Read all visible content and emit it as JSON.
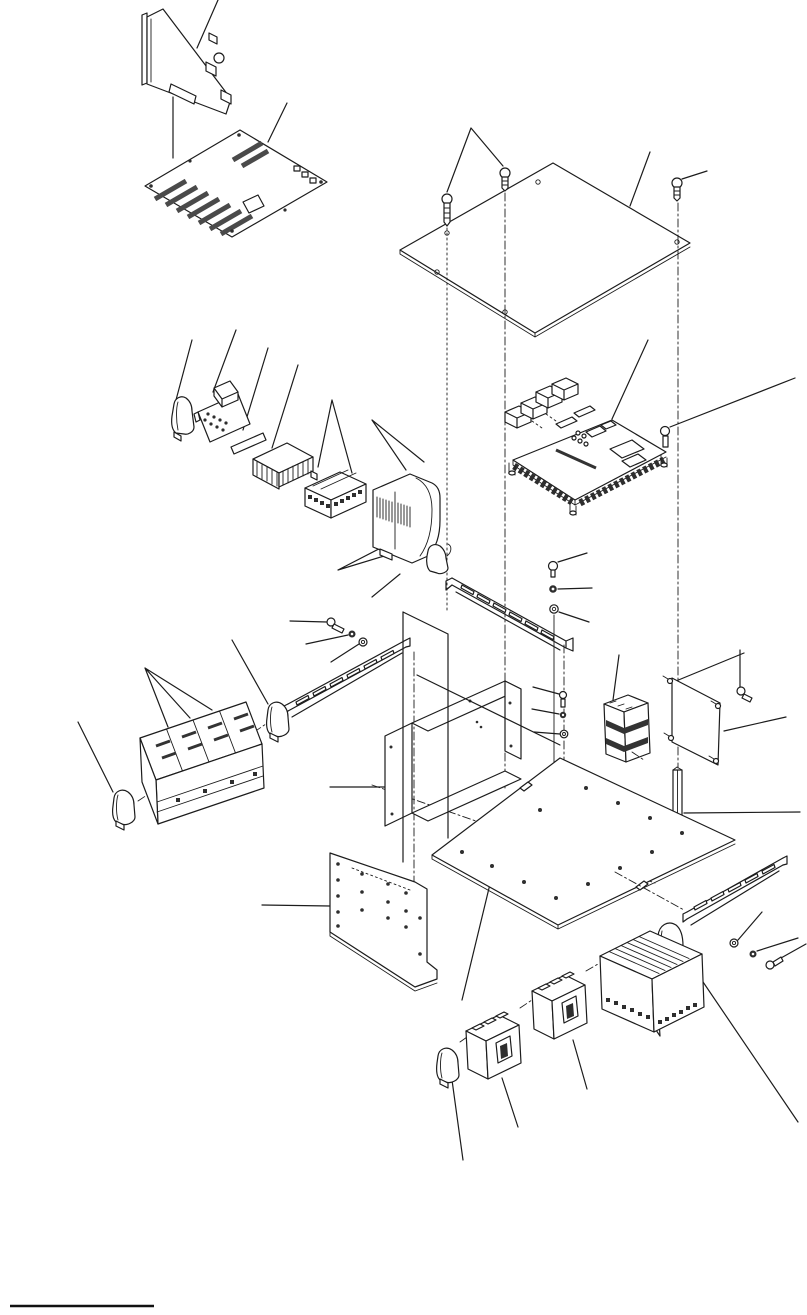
{
  "figure": {
    "kind": "exploded-parts-diagram",
    "description": "Exploded isometric service-manual illustration of an industrial control unit: cover plate, circuit boards, DIN rails, terminal blocks, circuit breakers, brackets and fasteners connected by leader lines",
    "labels_visible": false,
    "footnote_rule": {
      "present": true
    }
  },
  "colors": {
    "background": "#ffffff",
    "line": "#1c1c1c",
    "dark_fill": "#2e2e2e",
    "slot_fill": "#4a4a4a",
    "rule": "#111111"
  },
  "parts": [
    {
      "id": "adapter-card",
      "label": "Adapter card"
    },
    {
      "id": "backplane-board",
      "label": "Backplane board with slots"
    },
    {
      "id": "top-cover-plate",
      "label": "Top cover plate"
    },
    {
      "id": "cover-screws",
      "label": "Cover screws and alignment lines"
    },
    {
      "id": "controller-board",
      "label": "Controller board with connectors"
    },
    {
      "id": "controller-screw",
      "label": "Controller board screw"
    },
    {
      "id": "relay-end-clamp",
      "label": "End clamp"
    },
    {
      "id": "relay-socket",
      "label": "Relay and socket"
    },
    {
      "id": "marker-plate",
      "label": "Marker plate"
    },
    {
      "id": "spacer-block",
      "label": "Spacer block"
    },
    {
      "id": "terminal-connector",
      "label": "Terminal connector"
    },
    {
      "id": "power-module",
      "label": "Power module"
    },
    {
      "id": "module-end-clamp",
      "label": "End clamp"
    },
    {
      "id": "din-rail-center",
      "label": "DIN rail (center)"
    },
    {
      "id": "rail-fasteners-center",
      "label": "Screw, nut and washer"
    },
    {
      "id": "din-rail-left",
      "label": "DIN rail (left)"
    },
    {
      "id": "rail-fasteners-left",
      "label": "Screw, nut and washer"
    },
    {
      "id": "terminal-block-bank",
      "label": "Terminal block bank"
    },
    {
      "id": "bank-end-clamps",
      "label": "End clamps"
    },
    {
      "id": "mounting-bracket",
      "label": "Mounting bracket"
    },
    {
      "id": "divider-sheet",
      "label": "Divider sheet"
    },
    {
      "id": "stacked-terminal-block",
      "label": "Stacked terminal block"
    },
    {
      "id": "fastener-set-right",
      "label": "Screw, nut and washer"
    },
    {
      "id": "side-panel",
      "label": "Side panel with standoffs"
    },
    {
      "id": "panel-screw",
      "label": "Panel screw"
    },
    {
      "id": "support-rod",
      "label": "Support rod"
    },
    {
      "id": "base-plate",
      "label": "Base plate"
    },
    {
      "id": "mounting-plate",
      "label": "Mounting plate"
    },
    {
      "id": "din-rail-bottom",
      "label": "DIN rail (bottom)"
    },
    {
      "id": "rail-fasteners-bottom",
      "label": "Washer, nut and screw"
    },
    {
      "id": "rail-end-clamp",
      "label": "Rail end clamp"
    },
    {
      "id": "terminal-block-large",
      "label": "Terminal block"
    },
    {
      "id": "circuit-breaker-1",
      "label": "Circuit breaker"
    },
    {
      "id": "circuit-breaker-2",
      "label": "Circuit breaker"
    },
    {
      "id": "breaker-end-clamp",
      "label": "End clamp"
    },
    {
      "id": "footnote-rule",
      "label": "Footnote rule"
    }
  ]
}
